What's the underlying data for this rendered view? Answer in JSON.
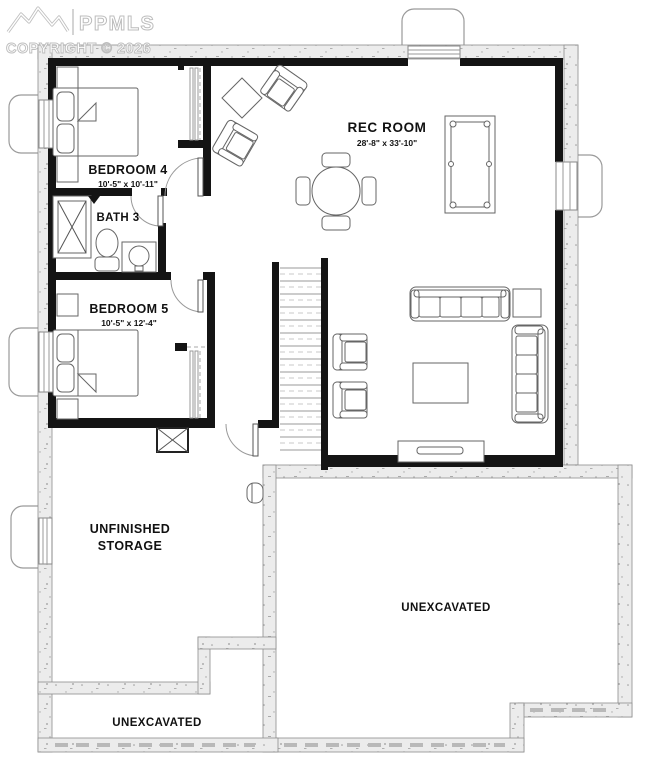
{
  "watermark": {
    "brand": "PPMLS",
    "copyright": "COPYRIGHT © 2026",
    "color": "#bdbdbd"
  },
  "plan": {
    "rooms": {
      "rec_room": {
        "name": "REC ROOM",
        "dims": "28'-8\" x 33'-10\""
      },
      "bedroom4": {
        "name": "BEDROOM 4",
        "dims": "10'-5\" x 10'-11\""
      },
      "bath3": {
        "name": "BATH 3"
      },
      "bedroom5": {
        "name": "BEDROOM 5",
        "dims": "10'-5\" x 12'-4\""
      },
      "storage": {
        "line1": "UNFINISHED",
        "line2": "STORAGE"
      },
      "unexcavated_right": {
        "name": "UNEXCAVATED"
      },
      "unexcavated_bottom": {
        "name": "UNEXCAVATED"
      }
    },
    "palette": {
      "interior_wall": "#141414",
      "foundation_wall_fill": "#ececec",
      "foundation_wall_edge": "#8d8d8d",
      "furniture_line": "#666666",
      "label_text": "#111111"
    }
  }
}
